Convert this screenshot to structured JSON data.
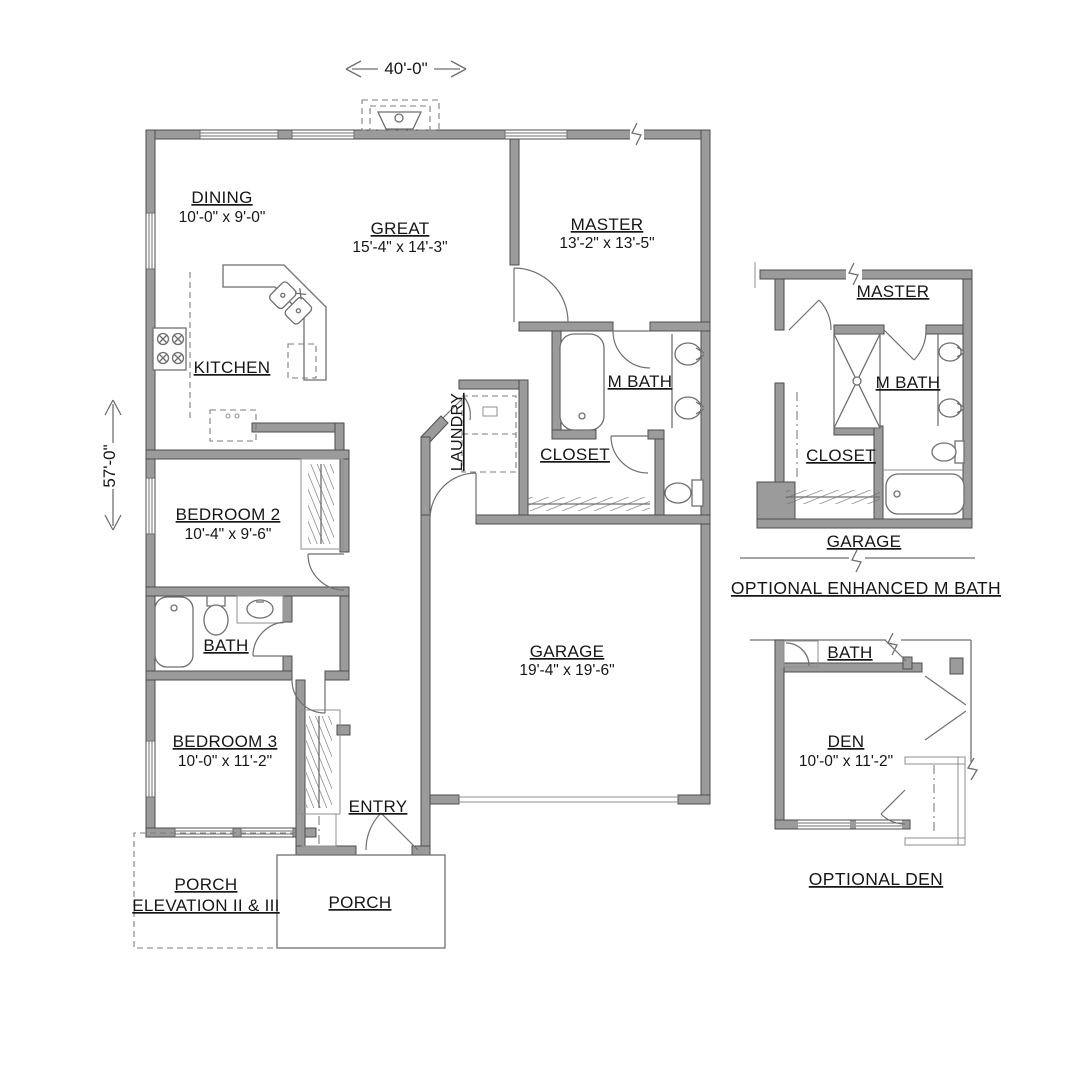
{
  "canvas": {
    "width": 1067,
    "height": 1090,
    "background": "#ffffff"
  },
  "colors": {
    "wall_fill": "#9b9b9b",
    "wall_stroke": "#4e4e4e",
    "line": "#6f6f6f",
    "text": "#161616"
  },
  "dimensions": {
    "overall_width": "40'-0\"",
    "overall_depth": "57'-0\""
  },
  "main_plan": {
    "rooms": {
      "dining": {
        "name": "DINING",
        "size": "10'-0\" x 9'-0\""
      },
      "great": {
        "name": "GREAT",
        "size": "15'-4\" x 14'-3\""
      },
      "master": {
        "name": "MASTER",
        "size": "13'-2\" x 13'-5\""
      },
      "kitchen": {
        "name": "KITCHEN"
      },
      "laundry": {
        "name": "LAUNDRY"
      },
      "m_bath": {
        "name": "M BATH"
      },
      "closet": {
        "name": "CLOSET"
      },
      "bedroom2": {
        "name": "BEDROOM 2",
        "size": "10'-4\" x 9'-6\""
      },
      "bath": {
        "name": "BATH"
      },
      "bedroom3": {
        "name": "BEDROOM 3",
        "size": "10'-0\" x 11'-2\""
      },
      "entry": {
        "name": "ENTRY"
      },
      "garage": {
        "name": "GARAGE",
        "size": "19'-4\" x 19'-6\""
      },
      "porch": {
        "name": "PORCH"
      },
      "porch_elevation": {
        "line1": "PORCH",
        "line2": "ELEVATION II & III"
      }
    }
  },
  "detail_enhanced_mbath": {
    "caption": "OPTIONAL ENHANCED M BATH",
    "rooms": {
      "master": "MASTER",
      "m_bath": "M BATH",
      "closet": "CLOSET",
      "garage": "GARAGE"
    }
  },
  "detail_optional_den": {
    "caption": "OPTIONAL DEN",
    "rooms": {
      "bath": "BATH",
      "den": {
        "name": "DEN",
        "size": "10'-0\" x 11'-2\""
      }
    }
  }
}
